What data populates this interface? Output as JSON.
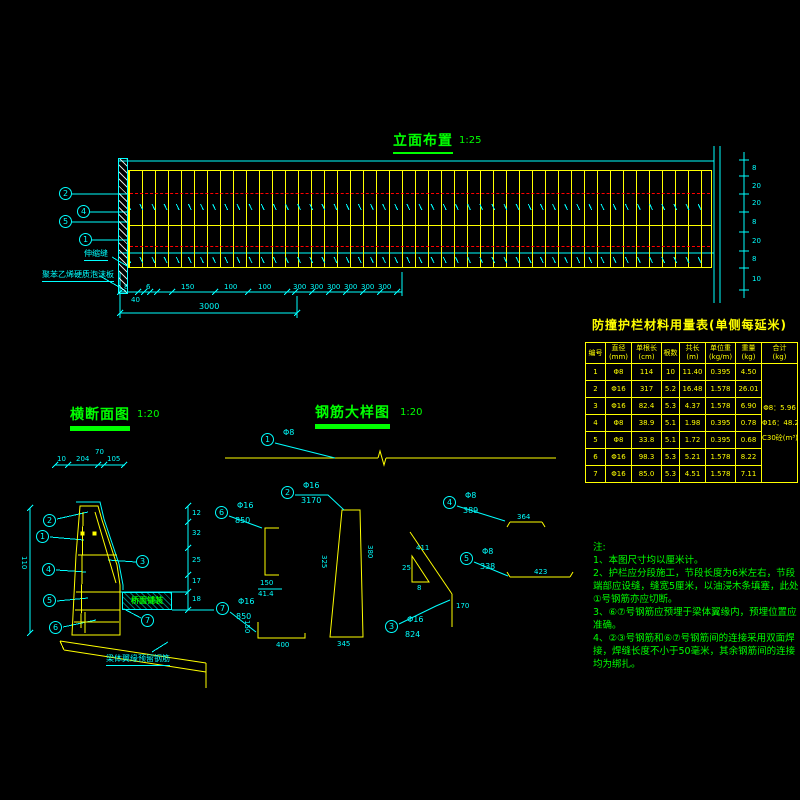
{
  "elevation": {
    "title": "立面布置",
    "scale": "1:25",
    "callouts": [
      "2",
      "4",
      "5",
      "1"
    ],
    "joint_label": "伸缩缝",
    "foam_label": "聚苯乙烯硬质泡沫板",
    "dims_row": [
      "8",
      "40",
      "6",
      "150",
      "100",
      "100",
      "300",
      "300",
      "300",
      "300",
      "300",
      "300"
    ],
    "dim_total": "3000",
    "right_dims": [
      "8",
      "20",
      "20",
      "8",
      "20",
      "8",
      "10"
    ]
  },
  "table": {
    "title": "防撞护栏材料用量表(单侧每延米)",
    "headers": [
      [
        "编号",
        ""
      ],
      [
        "直径",
        "(mm)"
      ],
      [
        "单根长",
        "(cm)"
      ],
      [
        "根数",
        ""
      ],
      [
        "共长",
        "(m)"
      ],
      [
        "单位重",
        "(kg/m)"
      ],
      [
        "重量",
        "(kg)"
      ],
      [
        "合计",
        "(kg)"
      ]
    ],
    "rows": [
      [
        "1",
        "Φ8",
        "114",
        "10",
        "11.40",
        "0.395",
        "4.50"
      ],
      [
        "2",
        "Φ16",
        "317",
        "5.2",
        "16.48",
        "1.578",
        "26.01"
      ],
      [
        "3",
        "Φ16",
        "82.4",
        "5.3",
        "4.37",
        "1.578",
        "6.90"
      ],
      [
        "4",
        "Φ8",
        "38.9",
        "5.1",
        "1.98",
        "0.395",
        "0.78"
      ],
      [
        "5",
        "Φ8",
        "33.8",
        "5.1",
        "1.72",
        "0.395",
        "0.68"
      ],
      [
        "6",
        "Φ16",
        "98.3",
        "5.3",
        "5.21",
        "1.578",
        "8.22"
      ],
      [
        "7",
        "Φ16",
        "85.0",
        "5.3",
        "4.51",
        "1.578",
        "7.11"
      ]
    ],
    "totals": [
      "Φ8：5.96",
      "Φ16：48.24",
      "C30砼(m³)：0.43"
    ]
  },
  "cross_section": {
    "title": "横断面图",
    "scale": "1:20",
    "top_dims": [
      "10",
      "204",
      "70",
      "105"
    ],
    "left_dim": "110",
    "right_dims": [
      "12",
      "32",
      "25",
      "17",
      "18"
    ],
    "callouts": [
      "2",
      "1",
      "4",
      "5",
      "6",
      "3",
      "7"
    ],
    "pavement_label": "桥面铺装",
    "flange_label": "梁体翼缘预留钢筋"
  },
  "rebar": {
    "title": "钢筋大样图",
    "scale": "1:20",
    "items": {
      "i1": {
        "no": "1",
        "dia": "Φ8",
        "len": ""
      },
      "i2": {
        "no": "2",
        "dia": "Φ16",
        "len": "3170"
      },
      "i3": {
        "no": "3",
        "dia": "Φ16",
        "len": "824"
      },
      "i4": {
        "no": "4",
        "dia": "Φ8",
        "len": "389"
      },
      "i5": {
        "no": "5",
        "dia": "Φ8",
        "len": "338"
      },
      "i6": {
        "no": "6",
        "dia": "Φ16",
        "len": "850"
      },
      "i7": {
        "no": "7",
        "dia": "Φ16",
        "len": "850"
      }
    },
    "dims": {
      "i6_a": "150",
      "i6_b": "41.4",
      "i2_left": "325",
      "i2_right": "380",
      "i2_bottom": "345",
      "i7_v": "150",
      "i7_h": "400",
      "i3_diag": "411",
      "i3_v": "170",
      "tri_v": "25",
      "tri_h": "8",
      "i4_bar": "364",
      "i5_bar": "423"
    }
  },
  "notes": {
    "heading": "注:",
    "lines": [
      "1、本图尺寸均以厘米计。",
      "2、护栏应分段施工，节段长度为6米左右，节段端部应设缝，缝宽5厘米，以油浸木条填塞，此处①号钢筋亦应切断。",
      "3、⑥⑦号钢筋应预埋于梁体翼缘内，预埋位置应准确。",
      "4、②③号钢筋和⑥⑦号钢筋间的连接采用双面焊接，焊缝长度不小于50毫米，其余钢筋间的连接均为绑扎。"
    ]
  }
}
